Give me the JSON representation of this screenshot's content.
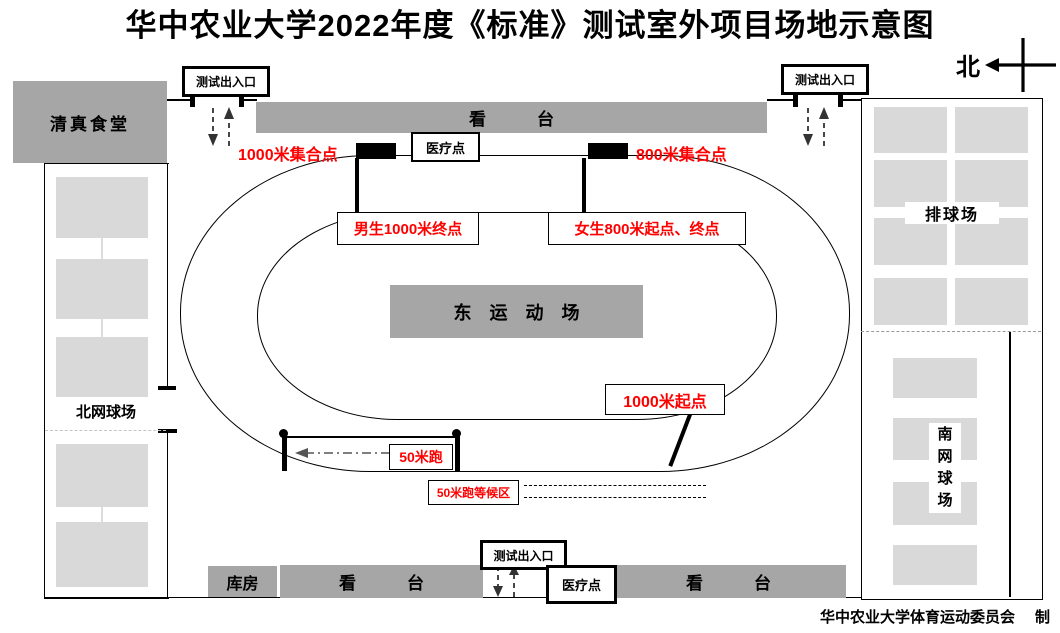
{
  "title": "华中农业大学2022年度《标准》测试室外项目场地示意图",
  "compass": {
    "north_label": "北"
  },
  "buildings": {
    "halal_canteen": "清真食堂",
    "warehouse": "库房",
    "north_tennis": "北网球场",
    "volleyball": "排球场",
    "south_tennis_chars": [
      "南",
      "网",
      "球",
      "场"
    ],
    "east_stadium": "东　运　动　场",
    "grandstand": "看　　　台"
  },
  "gates": {
    "test_entrance": "测试出入口"
  },
  "stations": {
    "medical_point": "医疗点"
  },
  "course_labels": {
    "assembly_1000m": "1000米集合点",
    "assembly_800m": "800米集合点",
    "male_1000m_finish": "男生1000米终点",
    "female_800m_start_finish": "女生800米起点、终点",
    "start_1000m": "1000米起点",
    "sprint_50m": "50米跑",
    "waiting_50m": "50米跑等候区"
  },
  "credit": {
    "committee": "华中农业大学体育运动委员会",
    "made_by": "制"
  },
  "colors": {
    "building_gray": "#a6a6a6",
    "court_gray": "#d9d9d9",
    "highlight_red": "#ff0000",
    "line_black": "#000000"
  }
}
